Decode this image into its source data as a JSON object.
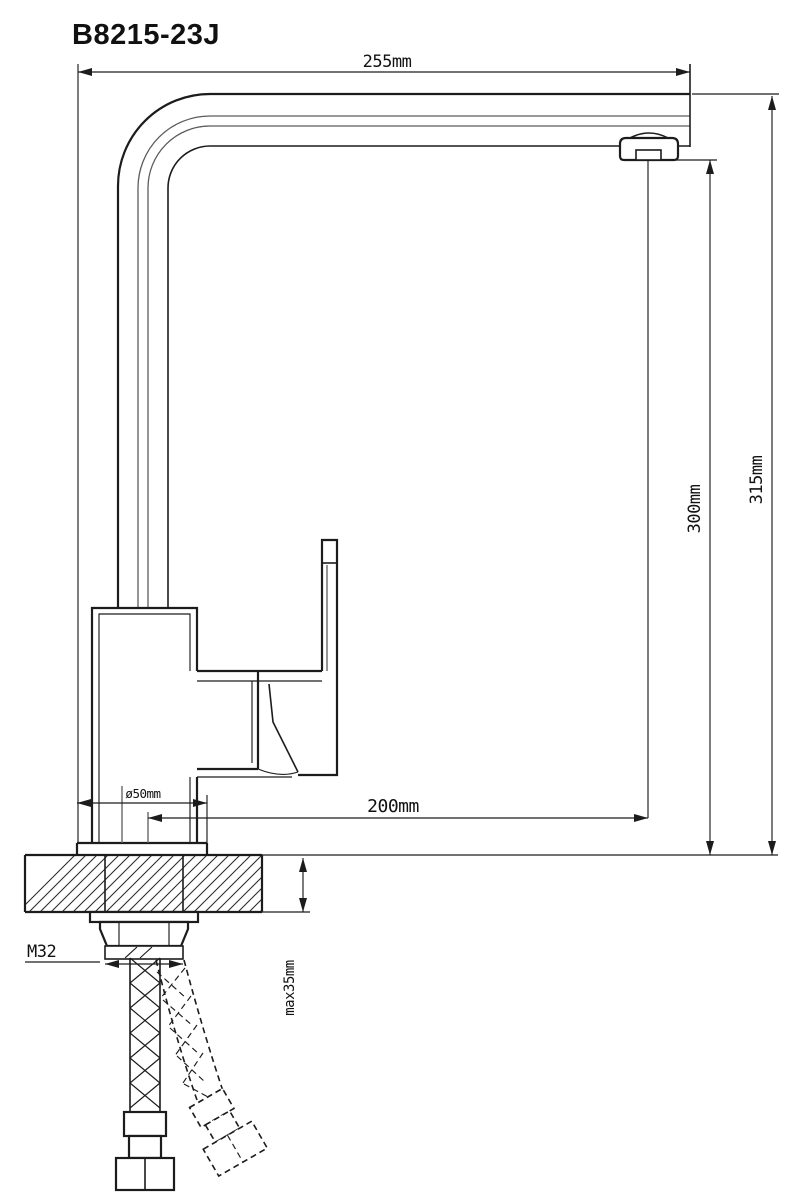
{
  "title": "B8215-23J",
  "dimensions": {
    "spout_width": "255mm",
    "overall_height": "315mm",
    "spout_height": "300mm",
    "spout_reach": "200mm",
    "base_diameter": "ø50mm",
    "mounting_thread": "M32",
    "max_counter_thickness": "max35mm"
  },
  "colors": {
    "background": "#ffffff",
    "line": "#1c1c1c",
    "line_soft": "#5c5c5c",
    "text": "#111111"
  }
}
